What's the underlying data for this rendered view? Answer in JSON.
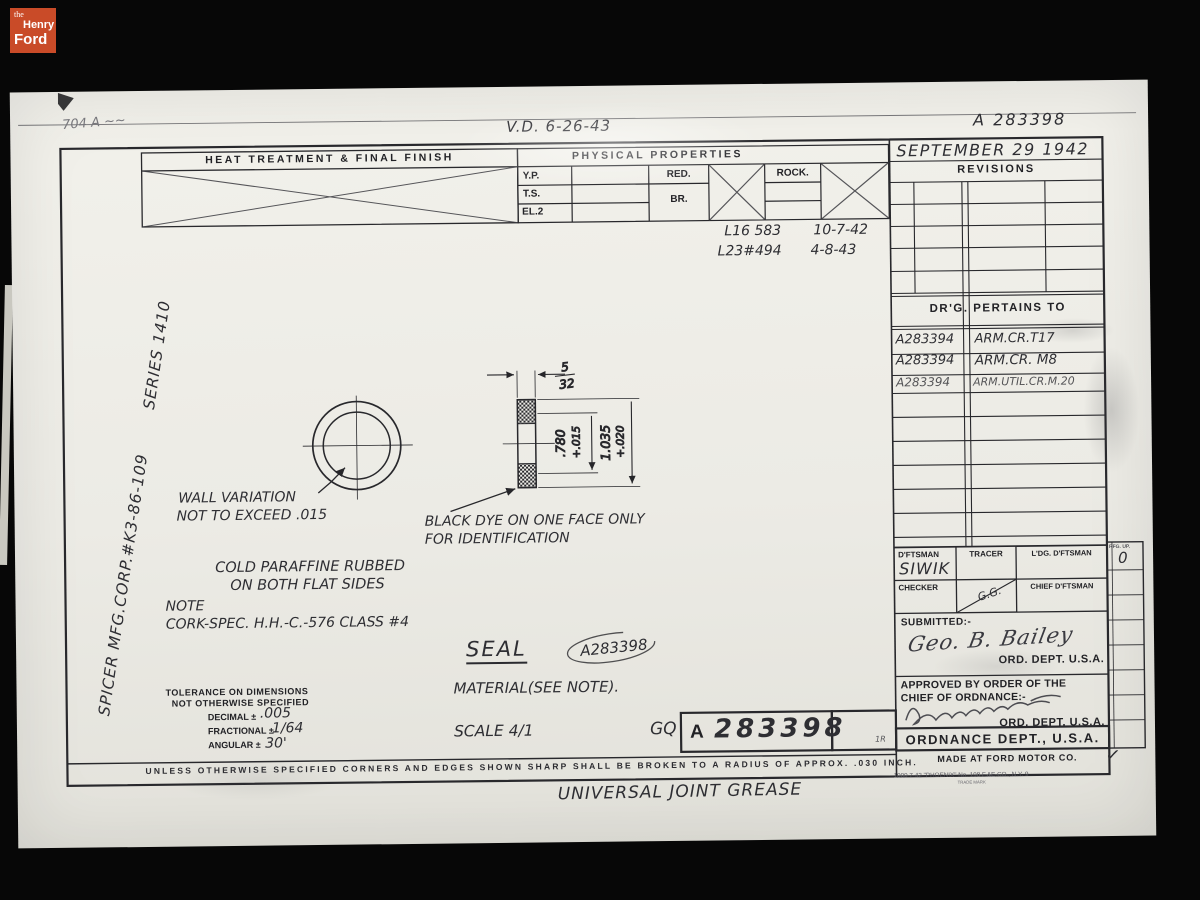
{
  "branding": {
    "the": "the",
    "henry": "Henry",
    "ford": "Ford"
  },
  "topbar": {
    "pencil_note": "704 A ~~",
    "vd": "V.D. 6-26-43",
    "number": "A 283398"
  },
  "heat_block": {
    "title": "HEAT TREATMENT & FINAL FINISH"
  },
  "physical": {
    "title": "PHYSICAL PROPERTIES",
    "yp": "Y.P.",
    "ts": "T.S.",
    "el": "EL.2",
    "red": "RED.",
    "br": "BR.",
    "rock": "ROCK."
  },
  "revisions": {
    "date": "SEPTEMBER 29 1942",
    "title": "REVISIONS",
    "entries": [
      {
        "ref": "L16 583",
        "date": "10-7-42"
      },
      {
        "ref": "L23#494",
        "date": "4-8-43"
      }
    ]
  },
  "pertains": {
    "title": "DR'G. PERTAINS TO",
    "rows": [
      {
        "no": "A283394",
        "app": "ARM.CR.T17"
      },
      {
        "no": "A283394",
        "app": "ARM.CR. M8"
      },
      {
        "no": "A283394",
        "app": "ARM.UTIL.CR.M.20"
      }
    ]
  },
  "margin": {
    "vendor": "SPICER MFG.CORP.#K3-86-109",
    "series": "SERIES 1410"
  },
  "drawing": {
    "wall_note1": "WALL VARIATION",
    "wall_note2": "NOT TO EXCEED .015",
    "dye_note1": "BLACK DYE ON ONE FACE ONLY",
    "dye_note2": "FOR IDENTIFICATION",
    "paraffine1": "COLD PARAFFINE RUBBED",
    "paraffine2": "ON BOTH FLAT SIDES",
    "note_label": "NOTE",
    "note_text": "CORK-SPEC. H.H.-C.-576 CLASS #4",
    "dims": {
      "width_num": "5",
      "width_den": "32",
      "id_value": ".780",
      "id_tol": "+.015",
      "od_value": "1.035",
      "od_tol": "+.020"
    },
    "part_name": "SEAL",
    "ref_no": "A283398",
    "material": "MATERIAL(SEE NOTE).",
    "scale": "SCALE 4/1",
    "inspector": "GQ"
  },
  "tolerance": {
    "line1": "TOLERANCE ON DIMENSIONS",
    "line2": "NOT OTHERWISE SPECIFIED",
    "decimal": "DECIMAL ±",
    "decimal_val": ".005",
    "fractional": "FRACTIONAL ±",
    "fractional_val": "1/64",
    "angular": "ANGULAR ±",
    "angular_val": "30'"
  },
  "number_box": {
    "prefix": "A",
    "number": "283398",
    "mark": "1R"
  },
  "titleblock": {
    "dftsman": "D'FTSMAN",
    "dftsman_name": "SIWIK",
    "tracer": "TRACER",
    "ldg": "L'DG. D'FTSMAN",
    "checker": "CHECKER",
    "chief": "CHIEF D'FTSMAN",
    "diag_initials": "G.G.",
    "strip_label": "RFG. UP.",
    "strip_value": "0",
    "submitted": "SUBMITTED:-",
    "submitted_sig": "Geo. B. Bailey",
    "ord_dept": "ORD. DEPT. U.S.A.",
    "approved1": "APPROVED BY ORDER OF THE",
    "approved2": "CHIEF OF ORDNANCE:-",
    "ordnance": "ORDNANCE DEPT., U.S.A.",
    "made_at": "MADE AT FORD MOTOR CO.",
    "check": "✓"
  },
  "footer": {
    "edge_note": "UNLESS OTHERWISE SPECIFIED CORNERS AND EDGES SHOWN SHARP SHALL BE BROKEN TO A RADIUS OF APPROX. .030 INCH.",
    "title": "UNIVERSAL JOINT GREASE",
    "print_ref": "1000  7-42  \"PHOENIX\" No. 198  F.&E.CO., N.Y.  9",
    "trademark": "TRADE MARK"
  }
}
